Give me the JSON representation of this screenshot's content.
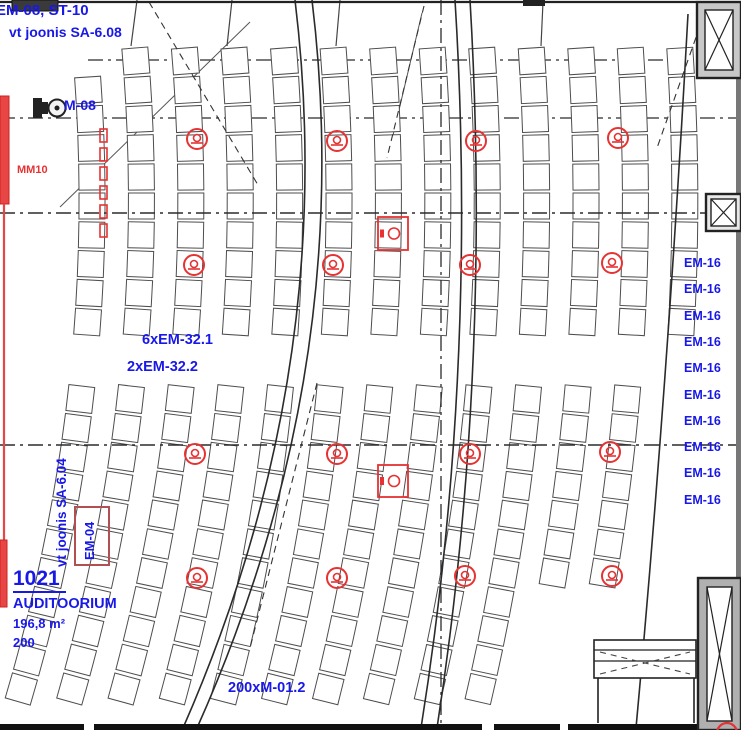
{
  "labels": {
    "top_left_line1": "EM-08, ST-10",
    "top_left_line2": "vt joonis SA-6.08",
    "projector": "M-08",
    "wall_strip": "MM10",
    "mid_line1": "6xEM-32.1",
    "mid_line2": "2xEM-32.2",
    "room_number": "1021",
    "room_name": "AUDITOORIUM",
    "room_area": "196,8 m²",
    "room_capacity": "200",
    "seats_label": "200xM-01.2",
    "floor_box": "EM-04",
    "side_note": "vt joonis SA-6.04"
  },
  "em16": [
    "EM-16",
    "EM-16",
    "EM-16",
    "EM-16",
    "EM-16",
    "EM-16",
    "EM-16",
    "EM-16",
    "EM-16",
    "EM-16"
  ],
  "colors": {
    "annotation_blue": "#1818E8",
    "highlight_red": "#E63232",
    "line_dark": "#2b2b2b"
  }
}
